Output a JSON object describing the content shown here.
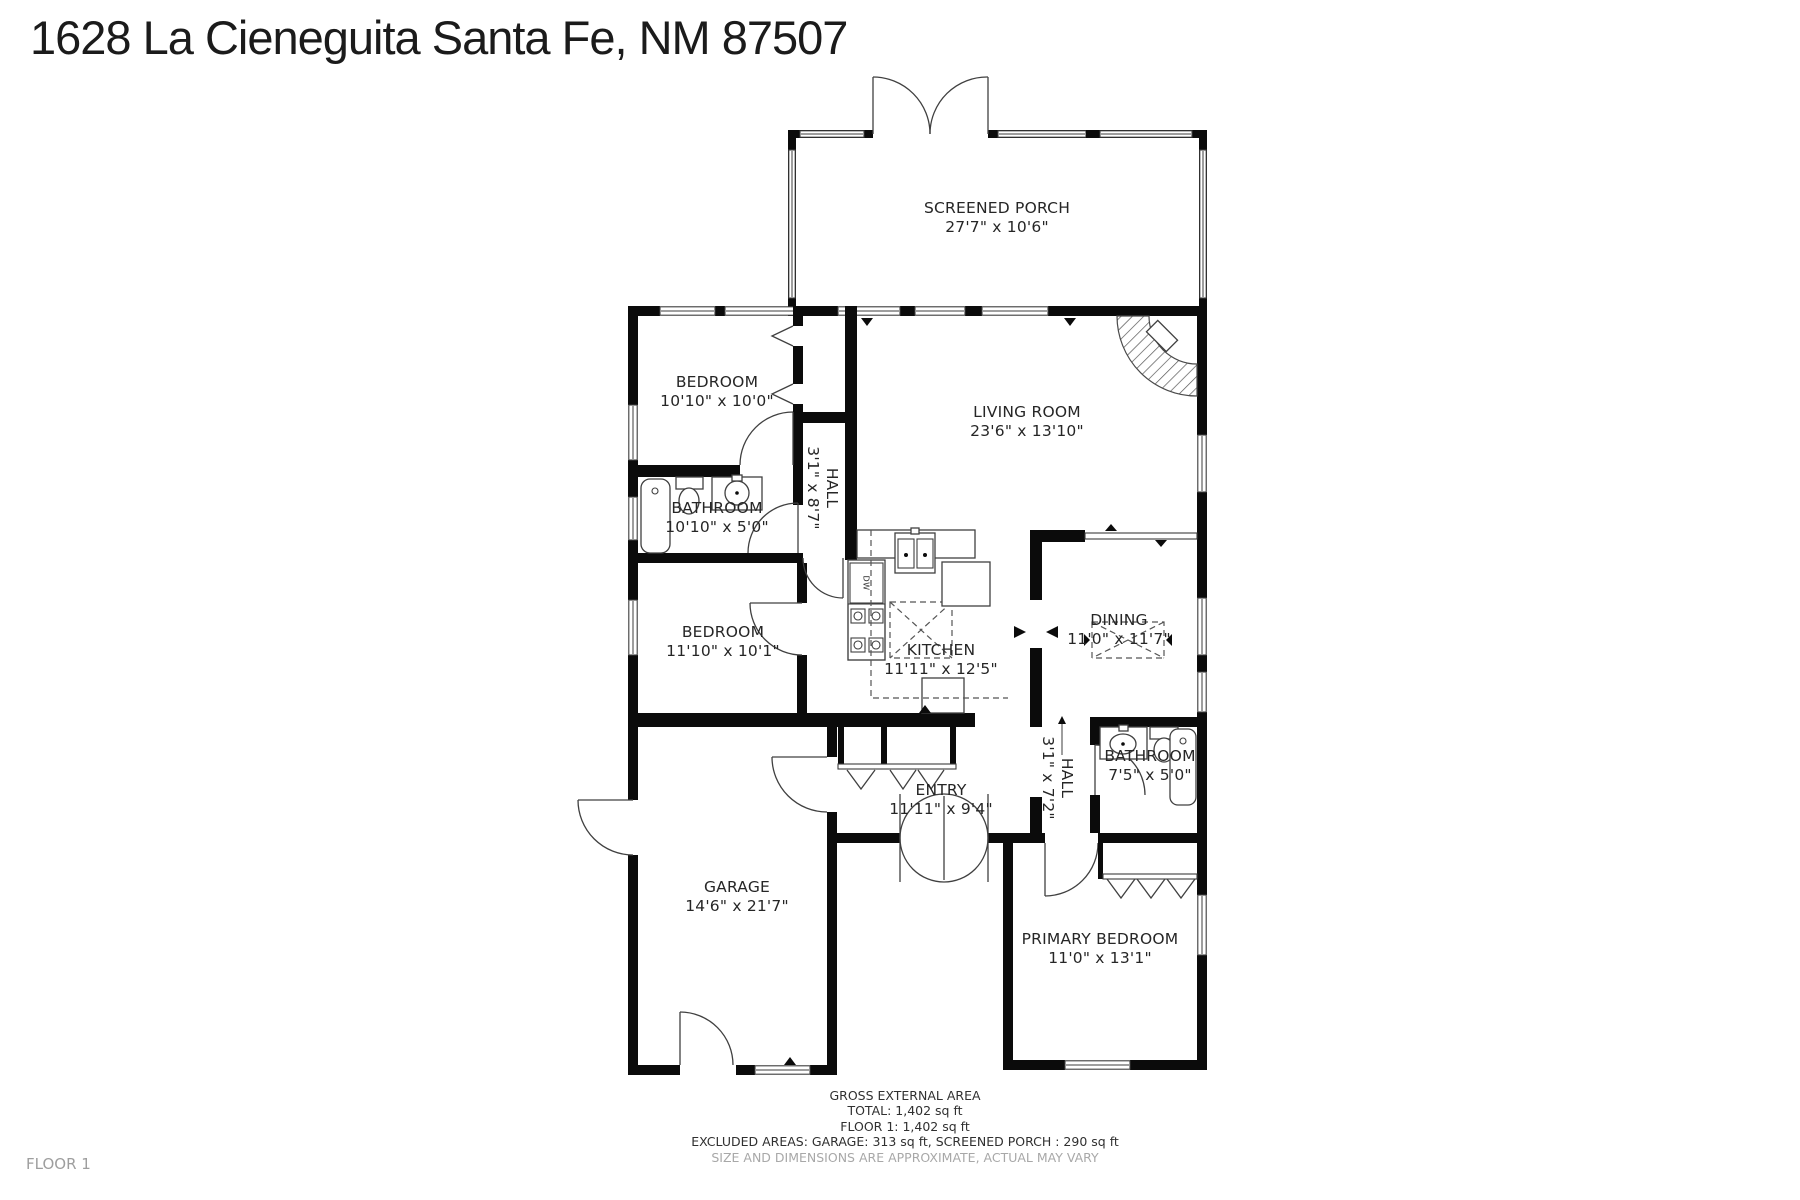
{
  "title": "1628 La Cieneguita Santa Fe, NM 87507",
  "floor_label": "FLOOR 1",
  "rooms": [
    {
      "name": "SCREENED PORCH",
      "dims": "27'7\" x 10'6\""
    },
    {
      "name": "BEDROOM",
      "dims": "10'10\" x 10'0\""
    },
    {
      "name": "LIVING ROOM",
      "dims": "23'6\" x 13'10\""
    },
    {
      "name": "BATHROOM",
      "dims": "10'10\" x 5'0\""
    },
    {
      "name": "HALL",
      "dims": "3'1\" x 8'7\""
    },
    {
      "name": "BEDROOM",
      "dims": "11'10\" x 10'1\""
    },
    {
      "name": "KITCHEN",
      "dims": "11'11\" x 12'5\""
    },
    {
      "name": "DINING",
      "dims": "11'0\" x 11'7\""
    },
    {
      "name": "ENTRY",
      "dims": "11'11\" x 9'4\""
    },
    {
      "name": "HALL",
      "dims": "3'1\" x 7'2\""
    },
    {
      "name": "BATHROOM",
      "dims": "7'5\" x 5'0\""
    },
    {
      "name": "GARAGE",
      "dims": "14'6\" x 21'7\""
    },
    {
      "name": "PRIMARY BEDROOM",
      "dims": "11'0\" x 13'1\""
    }
  ],
  "appliances": {
    "dishwasher": "DW"
  },
  "footer": {
    "line1": "GROSS EXTERNAL AREA",
    "line2": "TOTAL: 1,402 sq ft",
    "line3": "FLOOR 1: 1,402 sq ft",
    "line4": "EXCLUDED AREAS: GARAGE: 313 sq ft, SCREENED PORCH : 290 sq ft",
    "line5": "SIZE AND DIMENSIONS ARE APPROXIMATE, ACTUAL MAY VARY"
  },
  "colors": {
    "wall": "#0b0b0b",
    "text": "#262626",
    "muted": "#a8a8a8",
    "background": "#ffffff"
  }
}
